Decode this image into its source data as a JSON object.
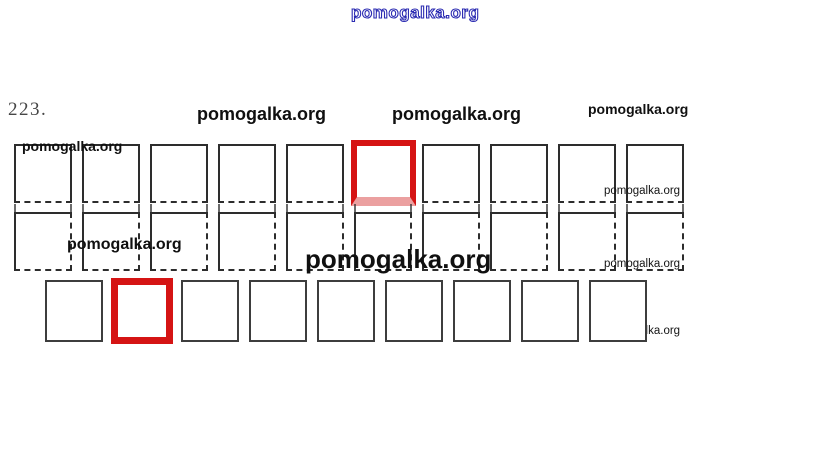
{
  "exercise": {
    "number": "223."
  },
  "watermarks": {
    "top_blue": "pomogalka.org",
    "mid_left_bold": "pomogalka.org",
    "mid_center_bold": "pomogalka.org",
    "mid_right_small": "pomogalka.org",
    "row1_overlay": "pomogalka.org",
    "row2_overlay": "pomogalka.org",
    "center_large": "pomogalka.org",
    "right_small_1": "pomogalka.org",
    "right_small_2": "pomogalka.org",
    "right_small_3": "pomogalka.org"
  },
  "figure": {
    "rows": [
      {
        "name": "top-row",
        "count": 10,
        "highlighted_index": 6,
        "highlight_style": "red-faded-bottom"
      },
      {
        "name": "middle-row",
        "count": 10,
        "highlighted_index": null,
        "highlight_style": null
      },
      {
        "name": "bottom-row",
        "count": 9,
        "highlighted_index": 2,
        "highlight_style": "red"
      }
    ]
  },
  "colors": {
    "highlight_red": "#d51414",
    "highlight_pink": "#eba0a0",
    "watermark_blue": "#2b2bb2",
    "square_border_dark": "#2d2d2d",
    "square_border_bottom_row": "#3d3d3d"
  }
}
